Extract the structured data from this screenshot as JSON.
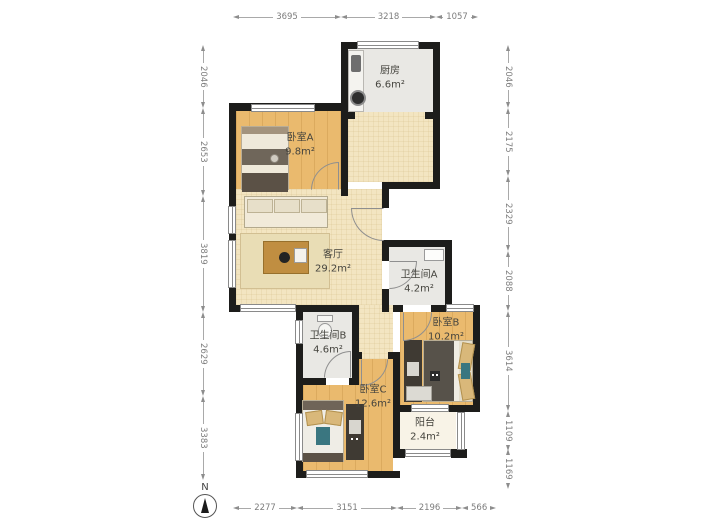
{
  "rooms": [
    {
      "id": "kitchen",
      "name": "厨房",
      "area": "6.6m²"
    },
    {
      "id": "bedroom-a",
      "name": "卧室A",
      "area": "9.8m²"
    },
    {
      "id": "living",
      "name": "客厅",
      "area": "29.2m²"
    },
    {
      "id": "bathroom-a",
      "name": "卫生间A",
      "area": "4.2m²"
    },
    {
      "id": "bathroom-b",
      "name": "卫生间B",
      "area": "4.6m²"
    },
    {
      "id": "bedroom-b",
      "name": "卧室B",
      "area": "10.2m²"
    },
    {
      "id": "bedroom-c",
      "name": "卧室C",
      "area": "12.6m²"
    },
    {
      "id": "balcony",
      "name": "阳台",
      "area": "2.4m²"
    }
  ],
  "dimensions": {
    "top": [
      "3695",
      "3218",
      "1057"
    ],
    "bottom": [
      "2277",
      "3151",
      "2196",
      "566"
    ],
    "left": [
      "2046",
      "2653",
      "3819",
      "2629",
      "3383"
    ],
    "right": [
      "2046",
      "2175",
      "2329",
      "2088",
      "3614",
      "1109",
      "1169"
    ]
  },
  "compass": {
    "label": "N"
  },
  "colors": {
    "wall": "#1d1d1b",
    "wood_floor": "#eaba6e",
    "living_floor": "#f3e5c1",
    "wet_floor": "#e9e8e4",
    "balcony_floor": "#f8f3e7",
    "dimension_text": "#7d7d7d"
  }
}
